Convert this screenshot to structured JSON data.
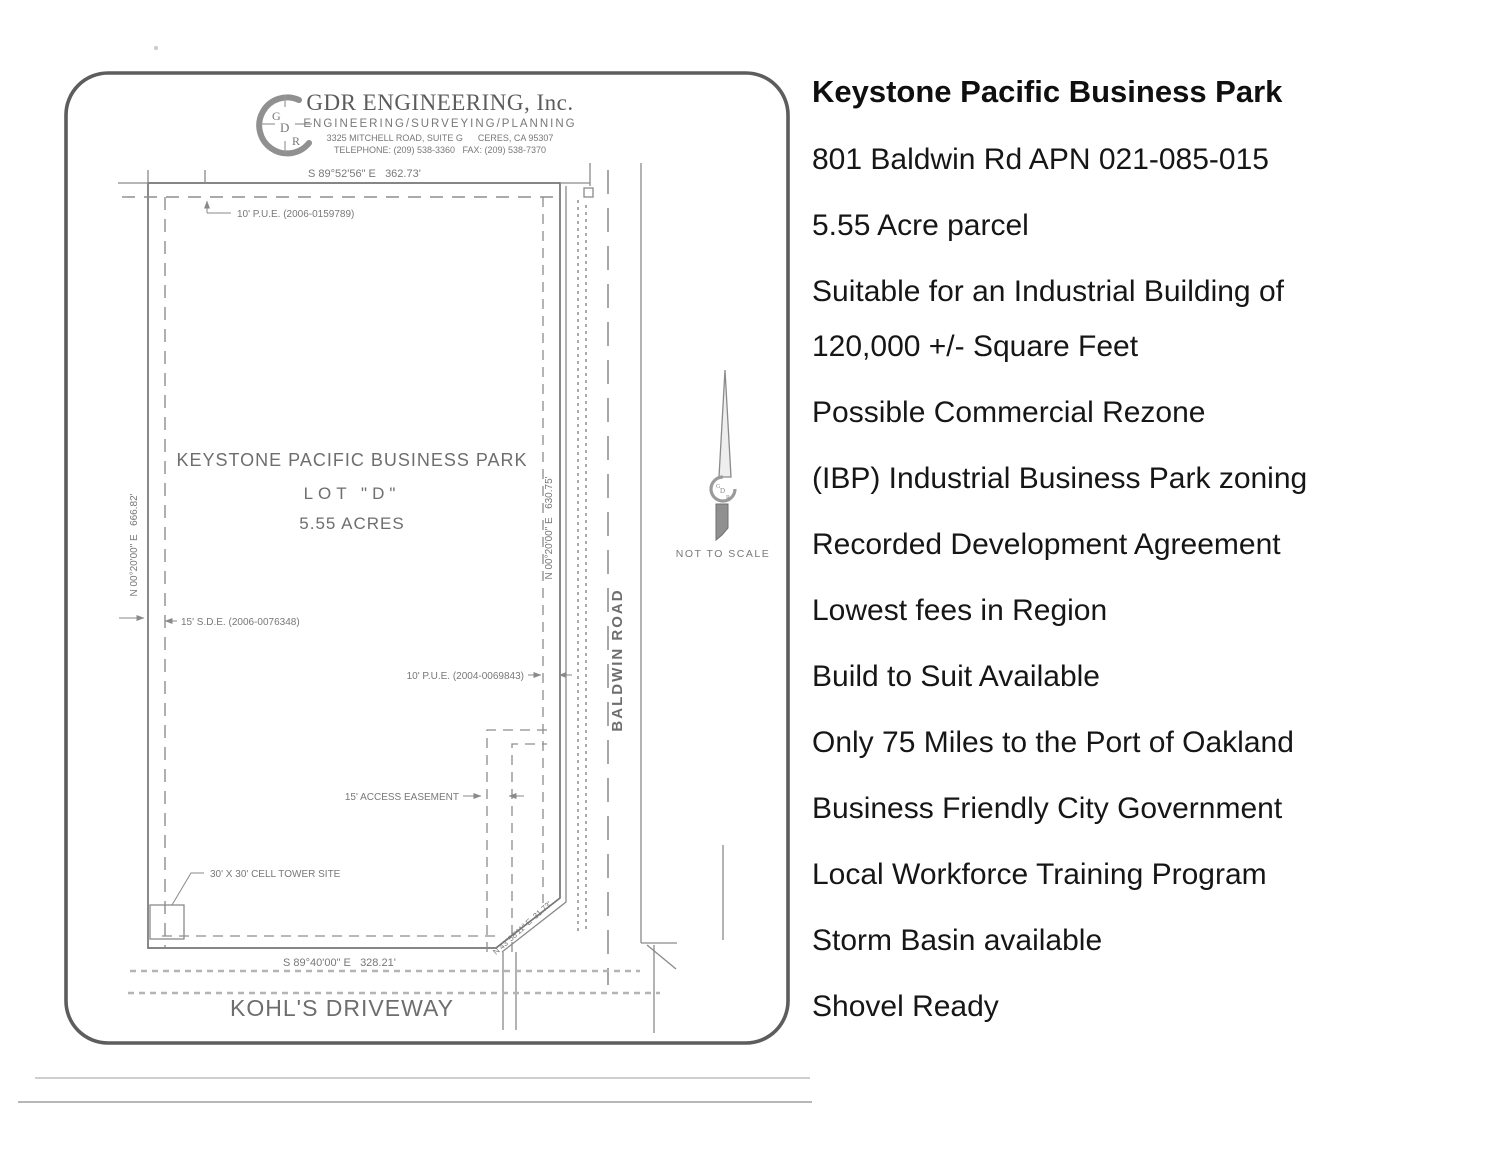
{
  "colors": {
    "page_bg": "#ffffff",
    "plan_border": "#5d5d5d",
    "plan_line": "#757575",
    "plan_text": "#787878",
    "panel_text": "#151515"
  },
  "plan": {
    "firm": {
      "logo_g": "G",
      "logo_d": "D",
      "logo_r": "R",
      "name": "GDR ENGINEERING, Inc.",
      "tagline": "ENGINEERING/SURVEYING/PLANNING",
      "address": "3325 MITCHELL ROAD, SUITE G      CERES, CA 95307",
      "phone": "TELEPHONE: (209) 538-3360   FAX: (209) 538-7370"
    },
    "parcel": {
      "name": "KEYSTONE PACIFIC BUSINESS PARK",
      "lot": "LOT \"D\"",
      "area": "5.55 ACRES"
    },
    "bearings": {
      "north": "S 89°52'56\" E   362.73'",
      "west": "N 00°20'00\" E   666.82'",
      "east": "N 00°20'00\" E   630.75'",
      "south": "S 89°40'00\" E   328.21'",
      "corner": "N 43°58'11\" E  31.73'"
    },
    "easements": {
      "pue_north": "10' P.U.E. (2006-0159789)",
      "sde_west": "15' S.D.E. (2006-0076348)",
      "pue_east": "10' P.U.E. (2004-0069843)",
      "access": "15' ACCESS EASEMENT",
      "cell_tower": "30' X 30' CELL TOWER SITE"
    },
    "roads": {
      "east": "BALDWIN ROAD",
      "south": "KOHL'S DRIVEWAY"
    },
    "scale_note": "NOT TO SCALE"
  },
  "details": {
    "title": "Keystone Pacific Business Park",
    "items": [
      "801 Baldwin Rd APN 021-085-015",
      "5.55 Acre parcel",
      "Suitable for an Industrial Building of 120,000 +/- Square Feet",
      "Possible Commercial Rezone",
      "(IBP) Industrial Business Park zoning",
      "Recorded Development Agreement",
      "Lowest fees in Region",
      "Build to Suit Available",
      "Only 75 Miles to the Port of Oakland",
      "Business Friendly City Government",
      "Local Workforce Training Program",
      "Storm Basin available",
      "Shovel Ready"
    ]
  }
}
